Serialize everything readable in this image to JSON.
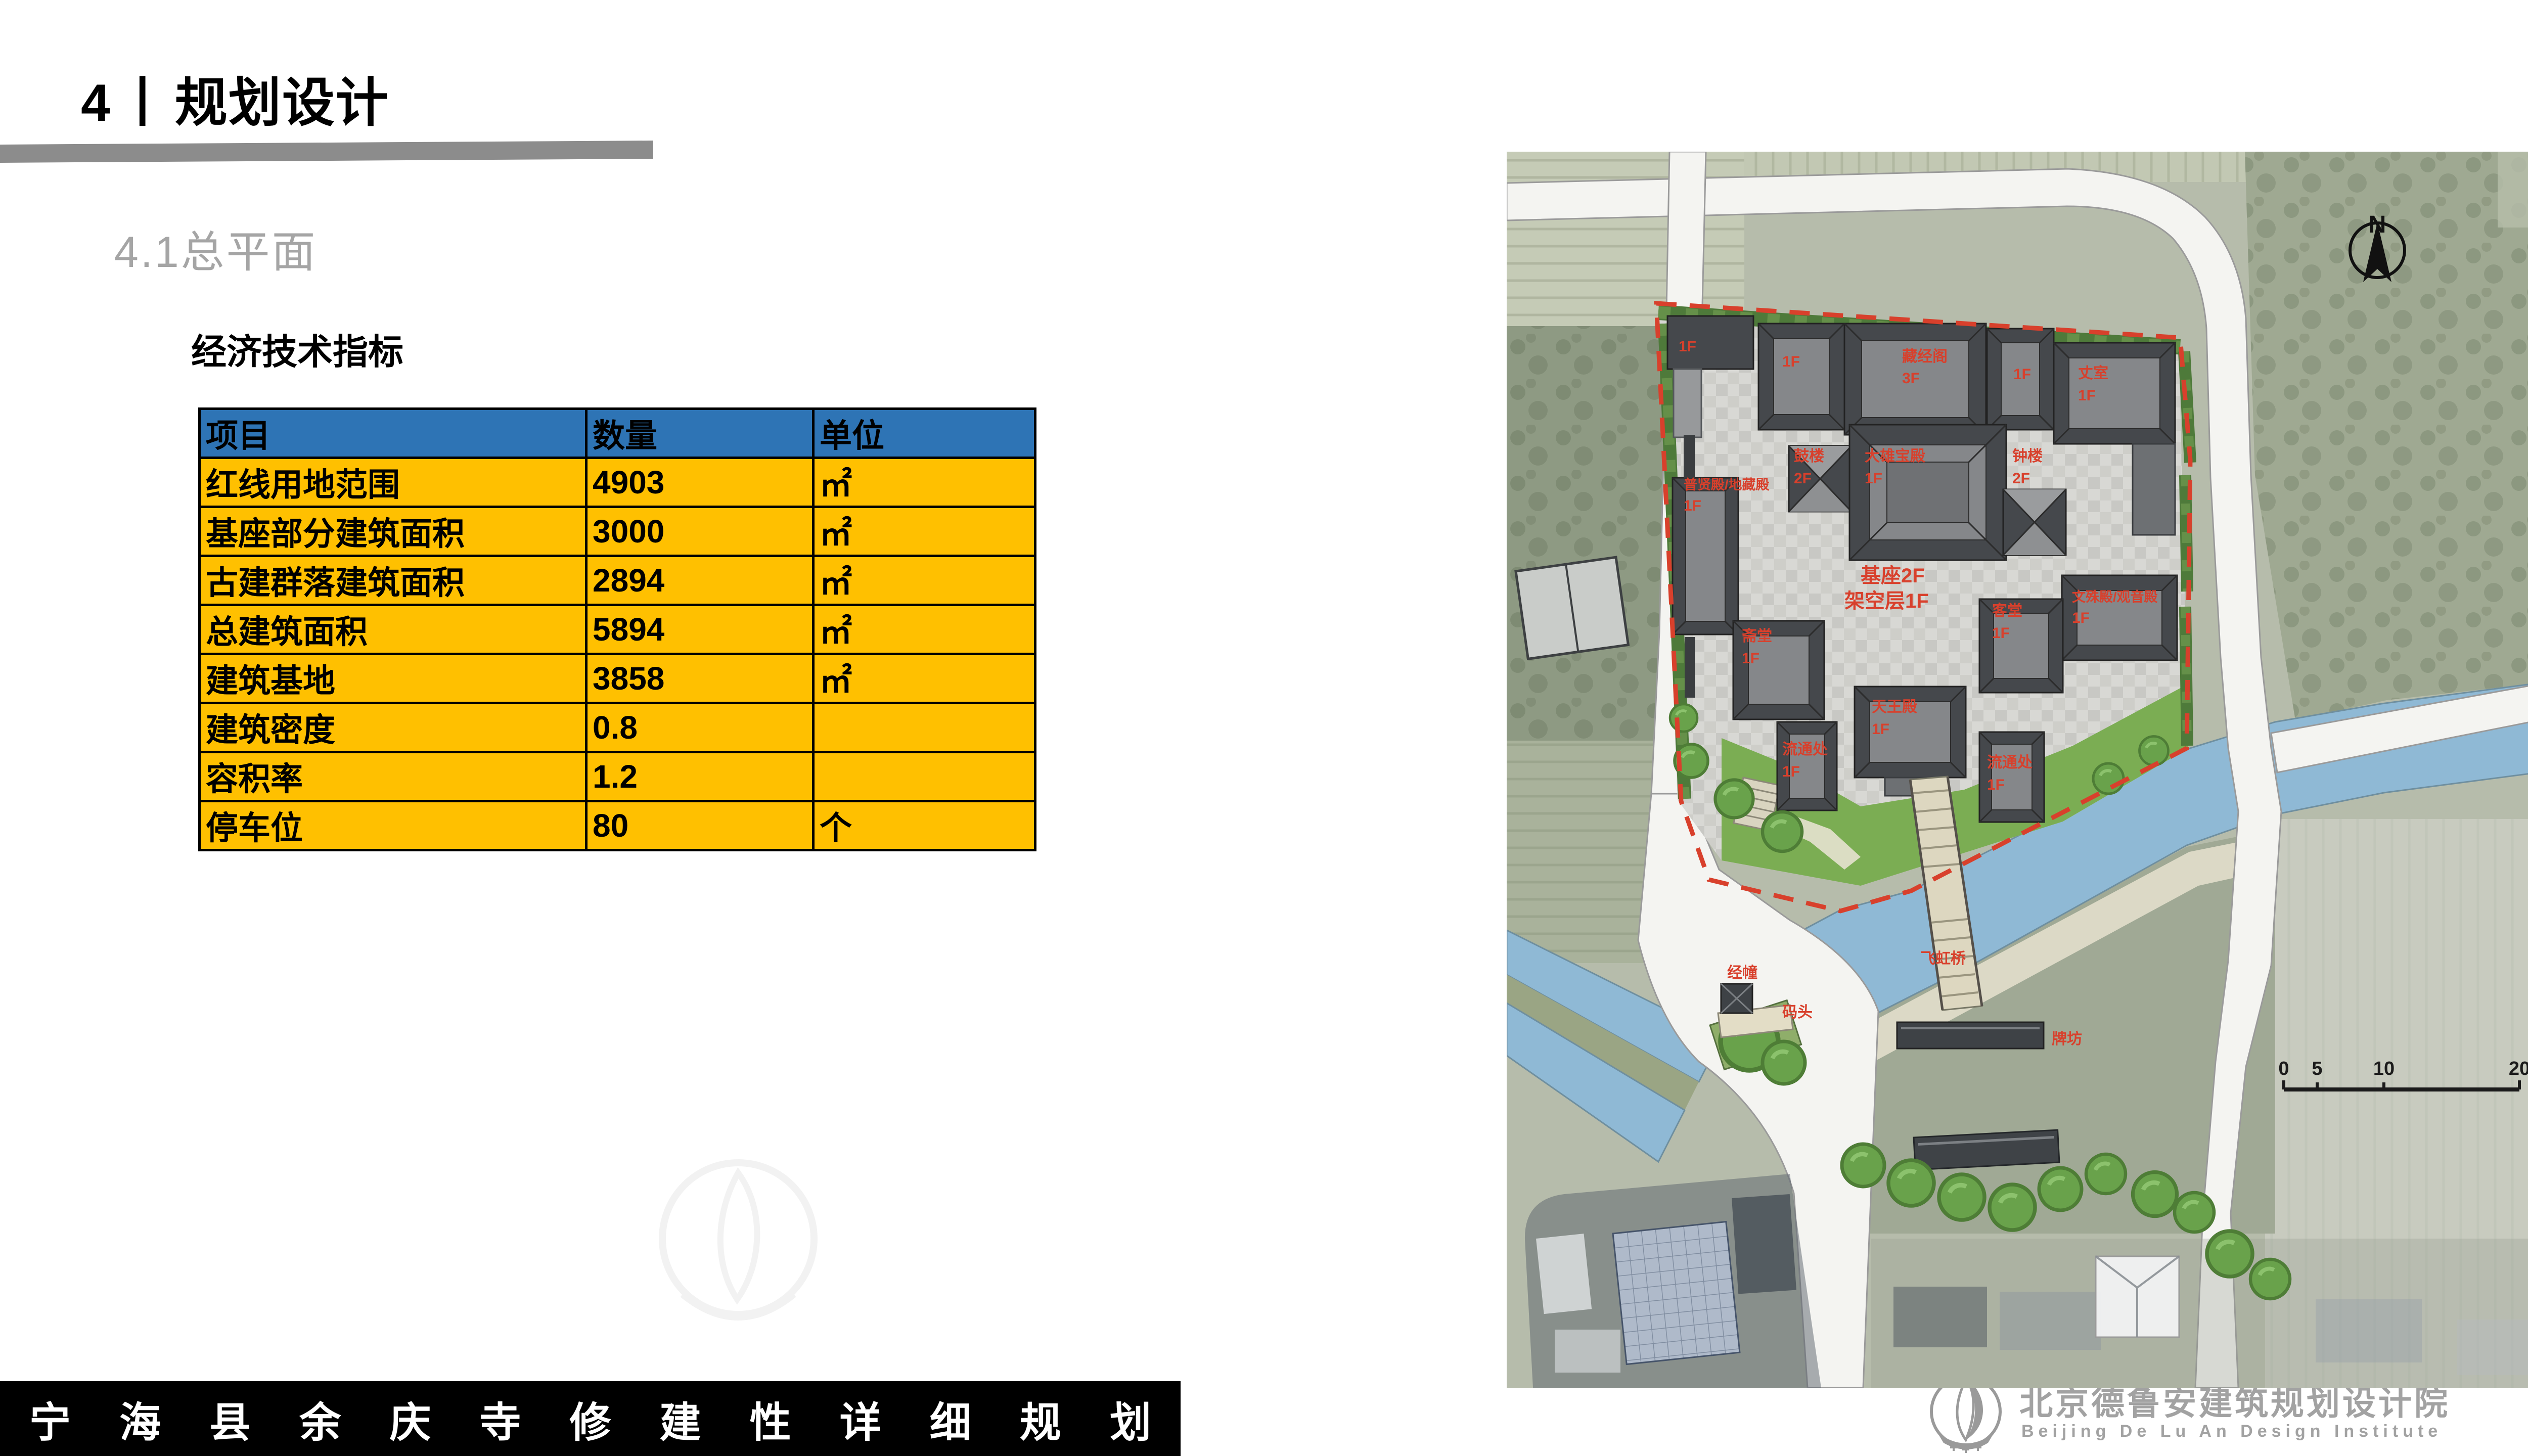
{
  "colors": {
    "accent_red": "#D8402C",
    "table_header_blue": "#2E74B5",
    "table_row_yellow": "#FFC000",
    "bar_gray": "#8C8C8C",
    "subtitle_gray": "#A5A5A5",
    "logo_gray": "#A2A2A2",
    "river_blue": "#8FB9D5",
    "lawn_green": "#7BAD53"
  },
  "header": {
    "section_number": "4",
    "separator": "丨",
    "section_title": "规划设计",
    "subtitle": "4.1总平面"
  },
  "indicators": {
    "heading": "经济技术指标",
    "table": {
      "columns": [
        "项目",
        "数量",
        "单位"
      ],
      "rows": [
        [
          "红线用地范围",
          "4903",
          "㎡"
        ],
        [
          "基座部分建筑面积",
          "3000",
          "㎡"
        ],
        [
          "古建群落建筑面积",
          "2894",
          "㎡"
        ],
        [
          "总建筑面积",
          "5894",
          "㎡"
        ],
        [
          "建筑基地",
          "3858",
          "㎡"
        ],
        [
          "建筑密度",
          "0.8",
          ""
        ],
        [
          "容积率",
          "1.2",
          ""
        ],
        [
          "停车位",
          "80",
          "个"
        ]
      ]
    }
  },
  "footer": {
    "title": "宁海县余庆寺修建性详细规划"
  },
  "logo": {
    "cn": "北京德鲁安建筑规划设计院",
    "en": "Beijing De Lu An Design Institute"
  },
  "map": {
    "north_label": "N",
    "scale_bar": {
      "ticks": [
        "0",
        "5",
        "10",
        "20"
      ]
    },
    "labels": [
      {
        "text": "1F"
      },
      {
        "text": "1F"
      },
      {
        "text": "藏经阁"
      },
      {
        "text": "3F"
      },
      {
        "text": "1F"
      },
      {
        "text": "丈室"
      },
      {
        "text": "1F"
      },
      {
        "text": "鼓楼"
      },
      {
        "text": "2F"
      },
      {
        "text": "大雄宝殿"
      },
      {
        "text": "1F"
      },
      {
        "text": "钟楼"
      },
      {
        "text": "2F"
      },
      {
        "text": "普贤殿/地藏殿"
      },
      {
        "text": "1F"
      },
      {
        "text": "文殊殿/观音殿"
      },
      {
        "text": "1F"
      },
      {
        "text": "斋堂"
      },
      {
        "text": "1F"
      },
      {
        "text": "客堂"
      },
      {
        "text": "1F"
      },
      {
        "text": "天王殿"
      },
      {
        "text": "1F"
      },
      {
        "text": "流通处"
      },
      {
        "text": "1F"
      },
      {
        "text": "流通处"
      },
      {
        "text": "1F"
      },
      {
        "text": "基座2F"
      },
      {
        "text": "架空层1F"
      },
      {
        "text": "飞虹桥"
      },
      {
        "text": "牌坊"
      },
      {
        "text": "经幢"
      },
      {
        "text": "码头"
      }
    ]
  }
}
